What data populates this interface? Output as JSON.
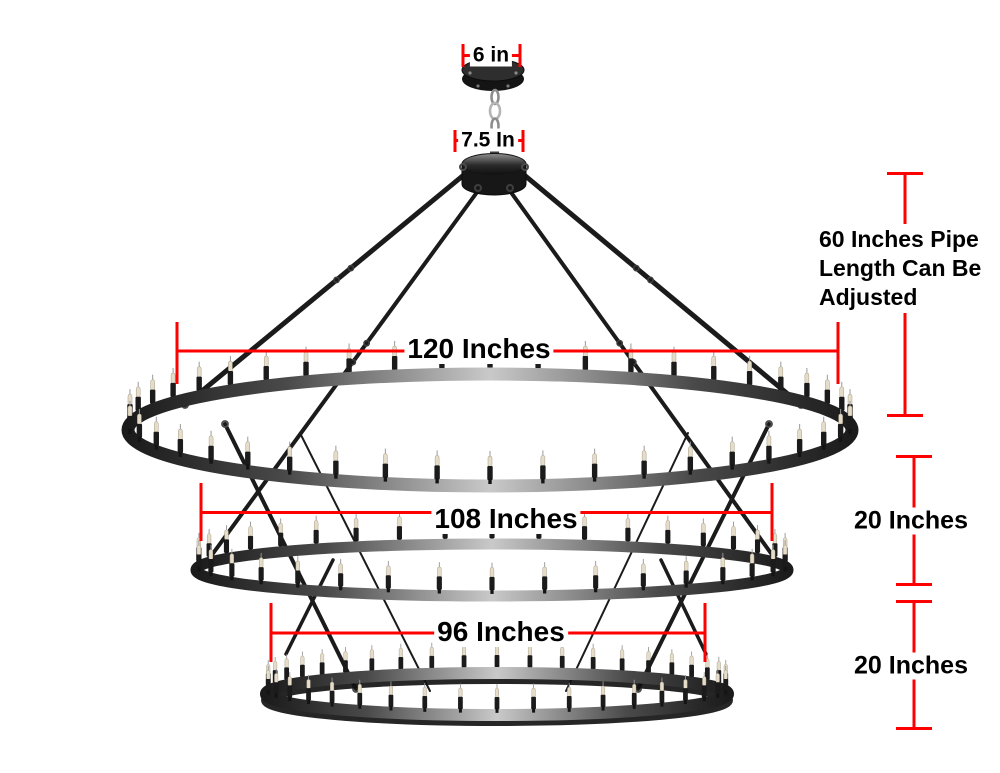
{
  "diagram": {
    "canopy_width_label": "6 in",
    "hub_width_label": "7.5 In",
    "pipe_length_note": "60 Inches Pipe Length Can Be Adjusted",
    "top_ring_label": "120 Inches",
    "middle_ring_label": "108 Inches",
    "bottom_ring_label": "96 Inches",
    "gap_top_middle_label": "20 Inches",
    "gap_middle_bottom_label": "20 Inches"
  },
  "colors": {
    "dimension_line": "#ff0000",
    "label_text": "#000000",
    "background": "#ffffff",
    "metal_dark": "#1b1b1b",
    "metal_highlight": "#c9c9c9",
    "bulb": "#e5ddca"
  }
}
